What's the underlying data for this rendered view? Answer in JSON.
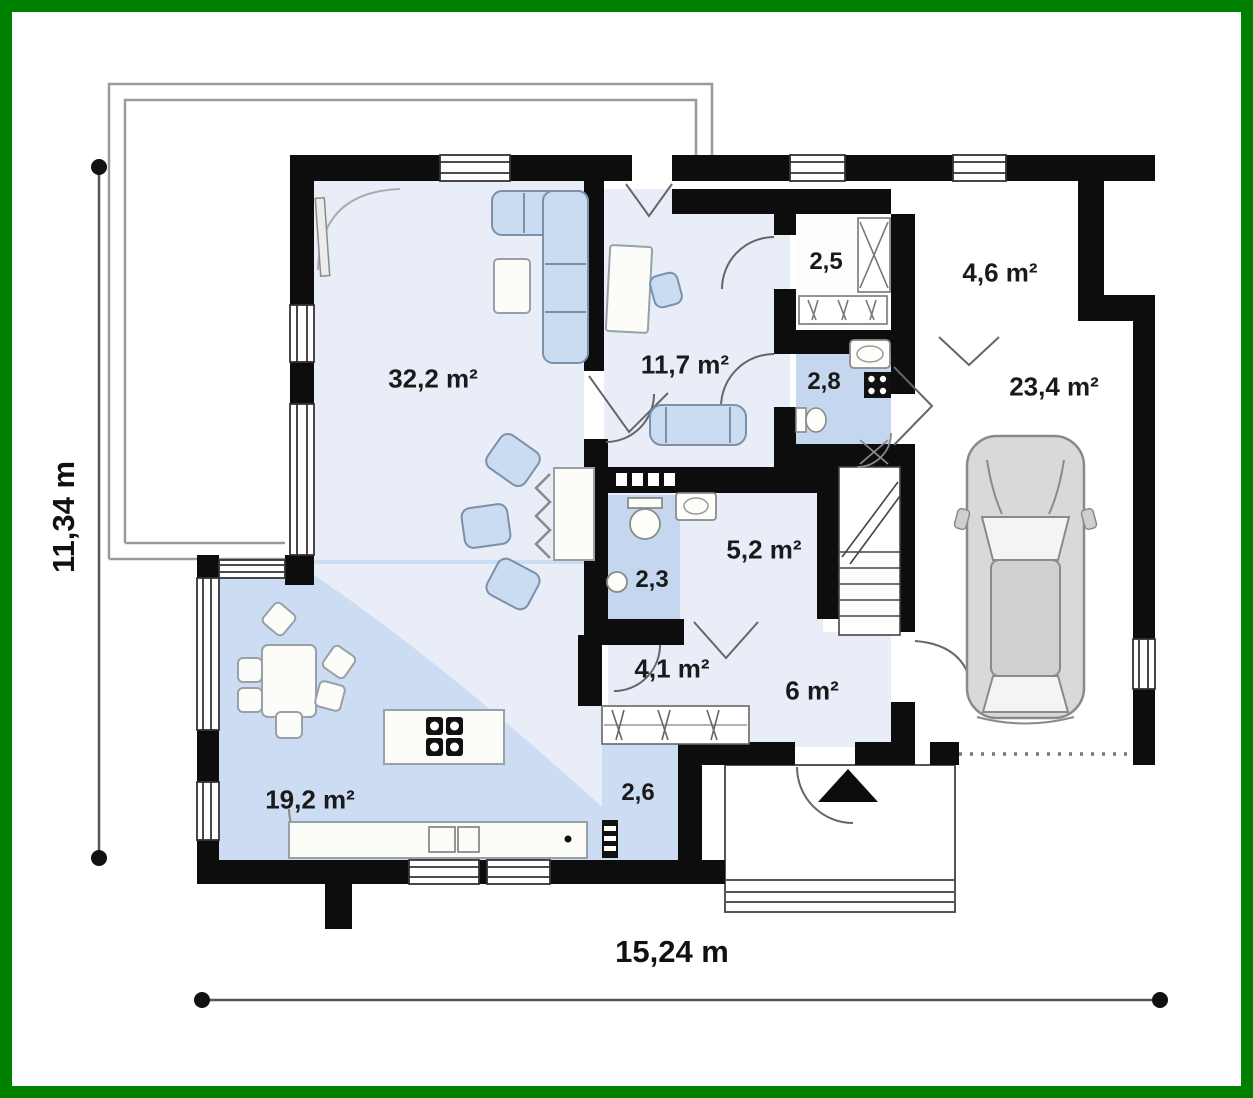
{
  "plan_title": "house ground floor plan",
  "colors": {
    "frame_green": "#008000",
    "wall_black": "#0d0d0d",
    "floor_pale": "#e9edf8",
    "floor_blue": "#ccdcf2",
    "floor_bath_blue": "#c5d7ee",
    "furniture_blue": "#cadcf2",
    "car_gray": "#d9d9d9"
  },
  "dimensions": {
    "height_label": "11,34 m",
    "width_label": "15,24 m"
  },
  "rooms": [
    {
      "name": "living-room",
      "label": "32,2 m²"
    },
    {
      "name": "study",
      "label": "11,7 m²"
    },
    {
      "name": "wardrobe",
      "label": "2,5"
    },
    {
      "name": "storage-room",
      "label": "4,6 m²"
    },
    {
      "name": "bathroom",
      "label": "2,8"
    },
    {
      "name": "garage",
      "label": "23,4 m²"
    },
    {
      "name": "utility-room",
      "label": "5,2 m²"
    },
    {
      "name": "wc",
      "label": "2,3"
    },
    {
      "name": "corridor",
      "label": "4,1 m²"
    },
    {
      "name": "hall",
      "label": "6 m²"
    },
    {
      "name": "kitchen-dining",
      "label": "19,2 m²"
    },
    {
      "name": "pantry",
      "label": "2,6"
    }
  ]
}
